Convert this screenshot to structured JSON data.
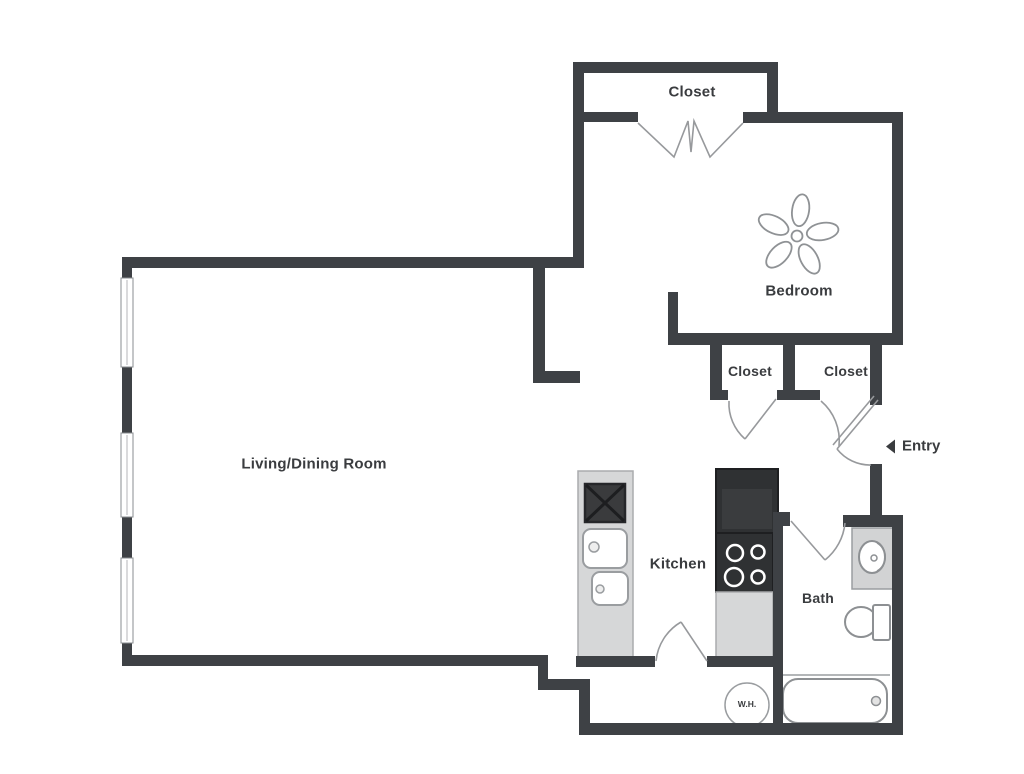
{
  "floorplan": {
    "rooms": {
      "living_dining": {
        "label": "Living/Dining Room"
      },
      "bedroom": {
        "label": "Bedroom"
      },
      "kitchen": {
        "label": "Kitchen"
      },
      "bath": {
        "label": "Bath"
      },
      "closet_top": {
        "label": "Closet"
      },
      "closet_left": {
        "label": "Closet"
      },
      "closet_right": {
        "label": "Closet"
      }
    },
    "markers": {
      "entry": {
        "label": "Entry",
        "arrow_icon": "left-triangle"
      },
      "water_heater": {
        "label": "W.H."
      }
    },
    "fixtures": [
      "ceiling-fan",
      "bifold-closet-doors",
      "door-swing",
      "entry-door",
      "refrigerator",
      "stove-4-burner",
      "kitchen-counter",
      "x-box-appliance",
      "double-sink",
      "vanity-sink",
      "toilet",
      "bathtub",
      "water-heater-tank",
      "window"
    ],
    "colors": {
      "wall": "#3e4145",
      "fixture_line": "#95989b",
      "counter_fill": "#d6d7d8",
      "appliance_dark": "#2f3133",
      "label_text": "#3a3c3f",
      "background": "#ffffff"
    }
  }
}
